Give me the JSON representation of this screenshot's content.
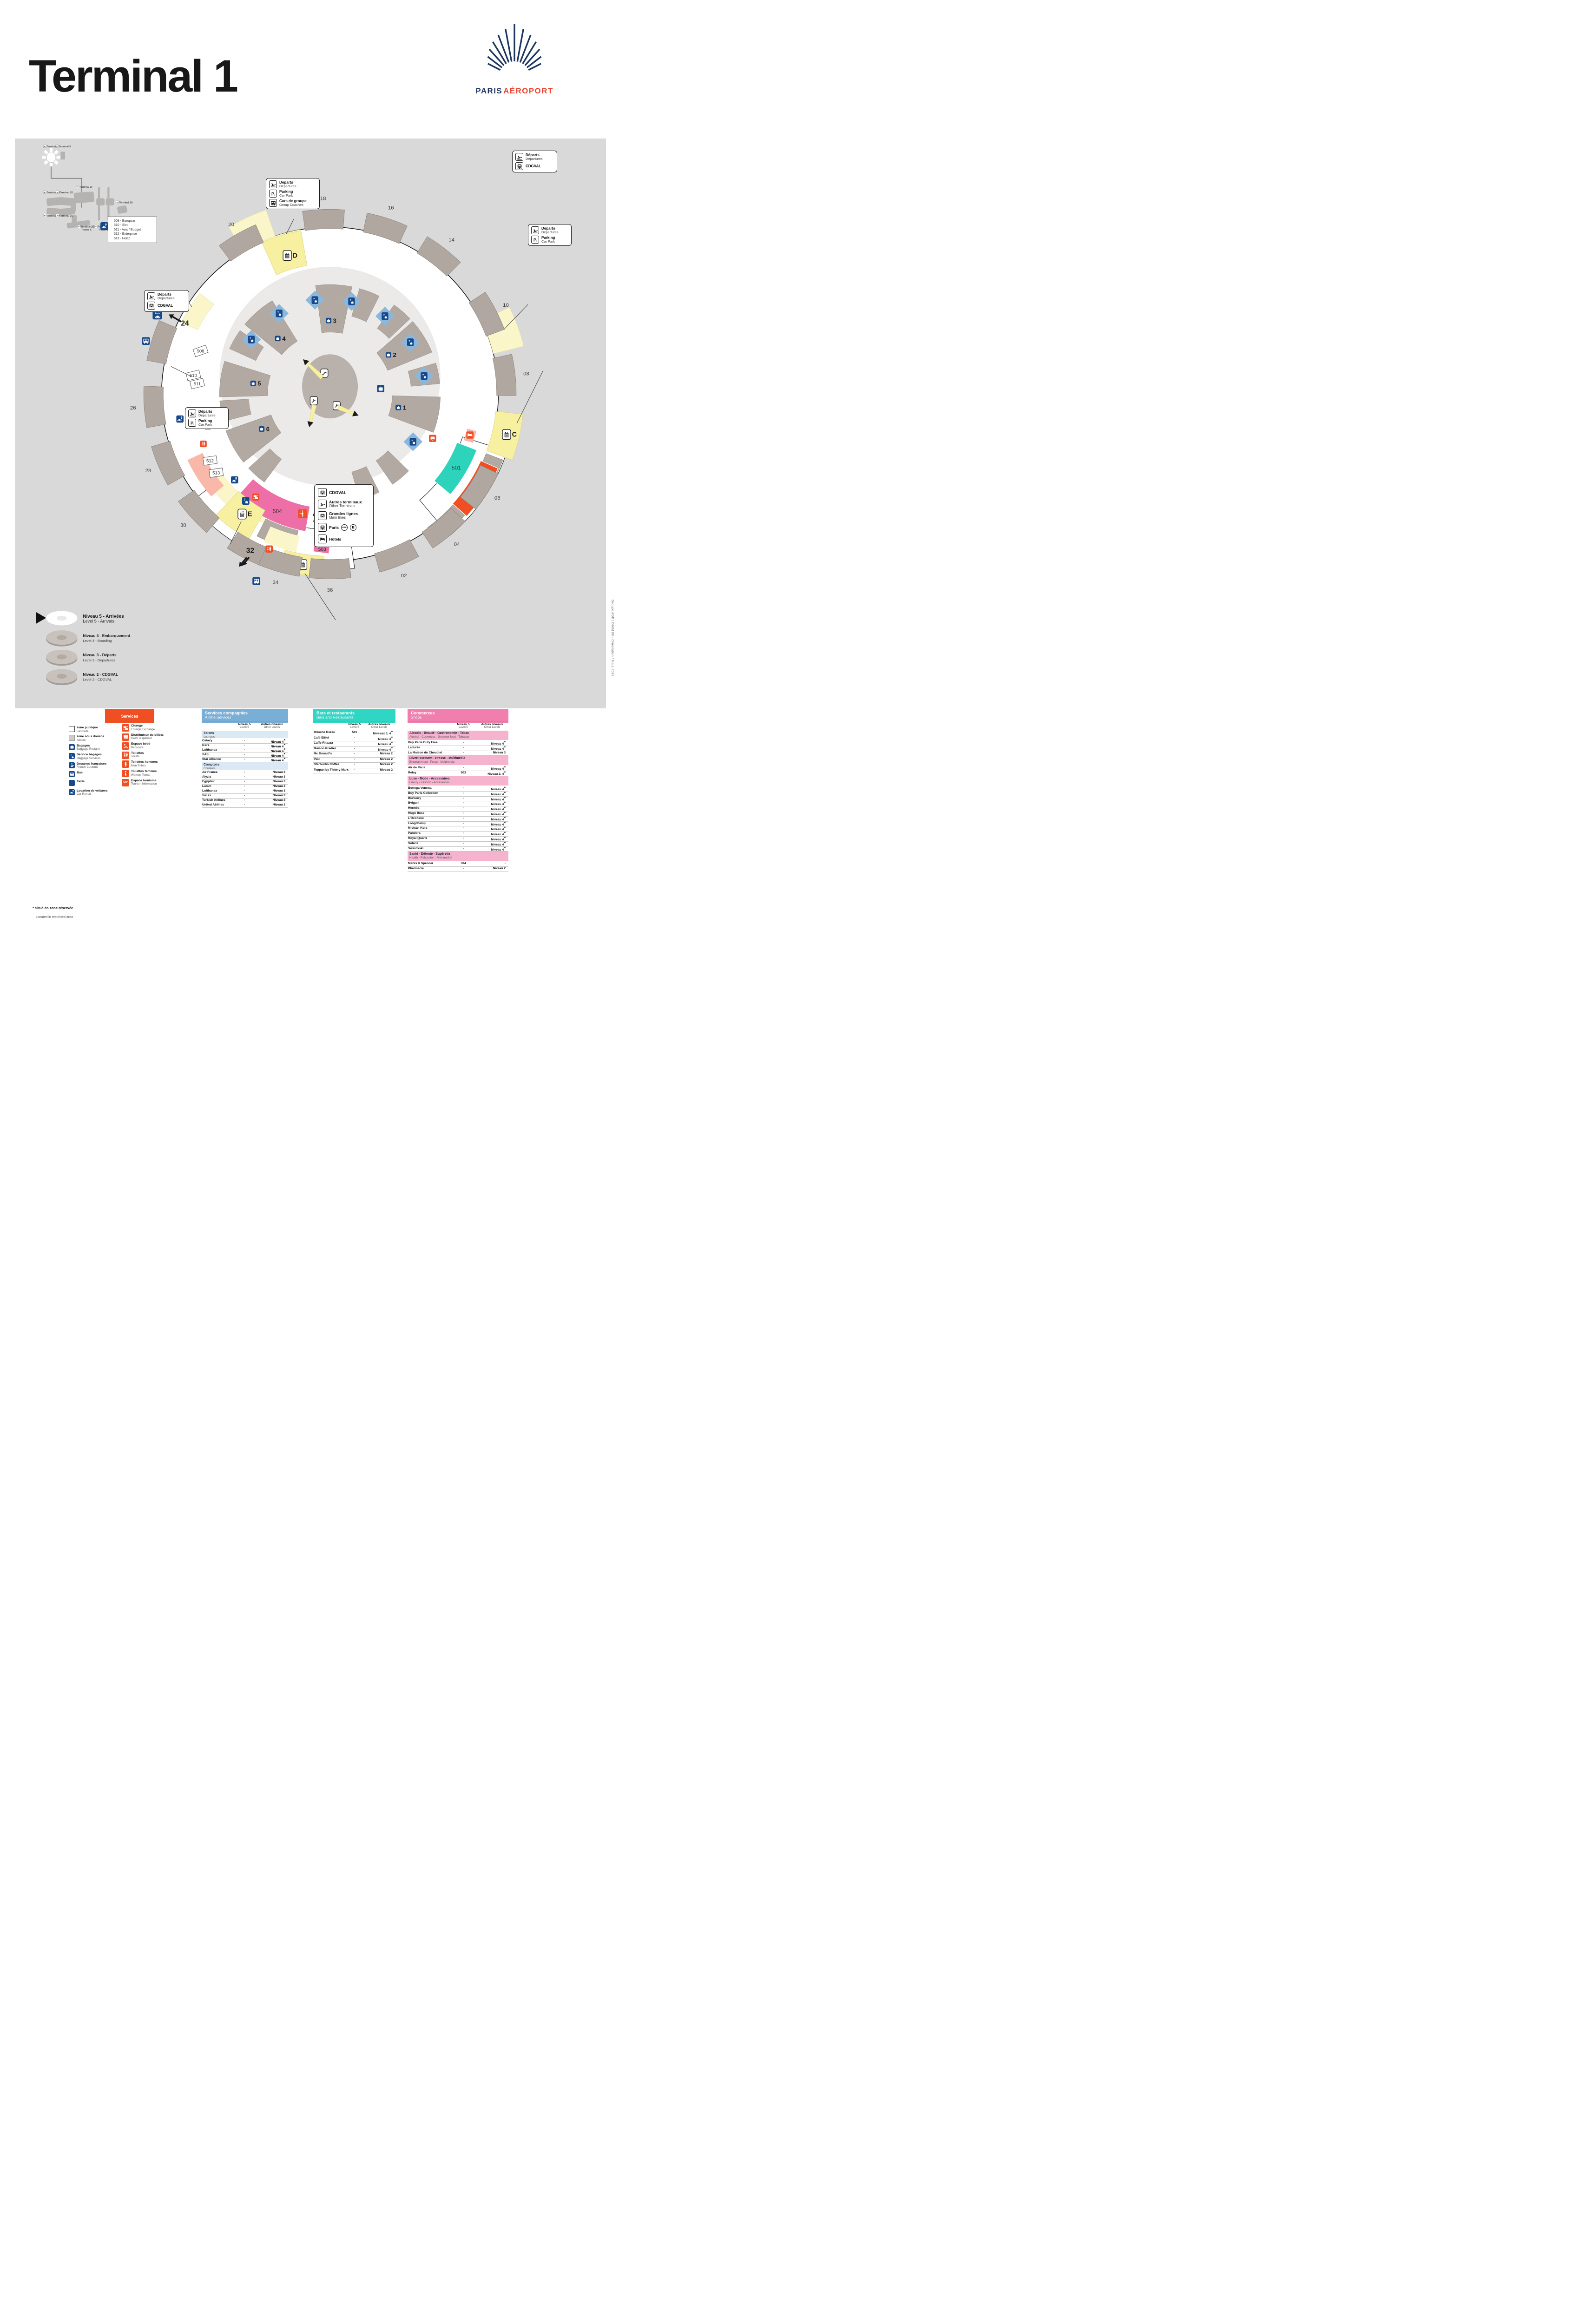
{
  "header": {
    "title": "Terminal 1",
    "logo": {
      "paris": "PARIS",
      "aeroport": "AÉROPORT"
    }
  },
  "minimap": {
    "terminals": [
      {
        "l1": "Terminal 1"
      },
      {
        "l1": "Terminal 3"
      },
      {
        "l1": "Terminal 2B"
      },
      {
        "l1": "Terminal 2D"
      },
      {
        "l1": "Terminal 2F"
      },
      {
        "l1": "Terminal 2A"
      },
      {
        "l1": "Terminal 2C"
      },
      {
        "l1": "Terminal 2E",
        "l2": "Portes K"
      },
      {
        "l1": "Terminal 2E",
        "l2": "Portes L"
      },
      {
        "l1": "Terminal 2E",
        "l2": "Portes M"
      },
      {
        "l1": "Terminal 2G"
      }
    ]
  },
  "map": {
    "gates": [
      "02",
      "04",
      "06",
      "08",
      "10",
      "14",
      "16",
      "18",
      "20",
      "26",
      "28",
      "30",
      "34",
      "36"
    ],
    "big_gates": [
      "24",
      "32"
    ],
    "stations": [
      "D",
      "E",
      "C",
      ""
    ],
    "halls": [
      "1",
      "2",
      "3",
      "4",
      "5",
      "6"
    ],
    "shops_on_map": [
      "501",
      "502",
      "503",
      "504"
    ],
    "counters": [
      "508",
      "510",
      "511",
      "512",
      "513"
    ],
    "taxi_label": "Taxis",
    "arrivals": {
      "fr": "Arrivées",
      "en": "Arrival"
    },
    "car_rental_list": [
      "508 - Europcar",
      "510 - Sixt",
      "511 - Avis / Budget",
      "512 - Enterprise",
      "513 - Hertz"
    ],
    "callouts": {
      "top": {
        "rows": [
          {
            "fr": "Départs",
            "en": "Departures",
            "icon": "takeoff"
          },
          {
            "fr": "Parking",
            "en": "Car Park",
            "icon": "p1"
          },
          {
            "fr": "Cars de groupe",
            "en": "Group Coaches",
            "icon": "bus"
          }
        ]
      },
      "left": {
        "rows": [
          {
            "fr": "Départs",
            "en": "Departures",
            "icon": "takeoff"
          },
          {
            "fr": "CDGVAL",
            "en": "",
            "icon": "train"
          }
        ]
      },
      "right_top": {
        "rows": [
          {
            "fr": "Départs",
            "en": "Departures",
            "icon": "takeoff"
          },
          {
            "fr": "CDGVAL",
            "en": "",
            "icon": "train"
          }
        ]
      },
      "right_mid": {
        "rows": [
          {
            "fr": "Départs",
            "en": "Departures",
            "icon": "takeoff"
          },
          {
            "fr": "Parking",
            "en": "Car Park",
            "icon": "p1"
          }
        ]
      },
      "bottom_left": {
        "rows": [
          {
            "fr": "Départs",
            "en": "Departures",
            "icon": "takeoff"
          },
          {
            "fr": "Parking",
            "en": "Car Park",
            "icon": "p1"
          }
        ]
      }
    },
    "transport_callout": [
      {
        "fr": "CDGVAL",
        "en": "",
        "icon": "train"
      },
      {
        "fr": "Autres terminaux",
        "en": "Other Terminals",
        "icon": "plane"
      },
      {
        "fr": "Grandes lignes",
        "en": "Main lines",
        "icon": "train"
      },
      {
        "fr": "Paris",
        "en": "",
        "icon": "train",
        "badges": [
          "RER",
          "B"
        ]
      },
      {
        "fr": "Hôtels",
        "en": "",
        "icon": "bed"
      }
    ],
    "levels": [
      {
        "fr": "Niveau 5 - Arrivées",
        "en": "Level 5 - Arrivals",
        "main": true
      },
      {
        "fr": "Niveau 4 - Embarquement",
        "en": "Level 4 - Boarding"
      },
      {
        "fr": "Niveau 3 - Départs",
        "en": "Level 3 - Departures"
      },
      {
        "fr": "Niveau 2 - CDGVAL",
        "en": "Level 2 - CDGVAL"
      }
    ],
    "credit": "Groupe ADP / DIAM 88 - Orientation / Mars 2018"
  },
  "legend": {
    "services": {
      "title": "Services",
      "general": [
        {
          "fr": "zone publique",
          "en": "Landside",
          "icon": "swatch-white"
        },
        {
          "fr": "zone sous douane",
          "en": "Airside",
          "icon": "swatch-gray"
        },
        {
          "fr": "Bagages",
          "en": "Baggage Reclaim",
          "icon": "bag"
        },
        {
          "fr": "Service bagages",
          "en": "Baggage Services",
          "icon": "qbag"
        },
        {
          "fr": "Douanes françaises",
          "en": "French Customs",
          "icon": "customs"
        },
        {
          "fr": "Bus",
          "en": "",
          "icon": "bus"
        },
        {
          "fr": "Taxis",
          "en": "",
          "icon": "taxi"
        },
        {
          "fr": "Location de voitures",
          "en": "Car Rental",
          "icon": "carkey"
        }
      ],
      "facilities": [
        {
          "fr": "Change",
          "en": "Foreign Exchange",
          "icon": "change"
        },
        {
          "fr": "Distributeur de billets",
          "en": "Cash Dispenser",
          "icon": "cash"
        },
        {
          "fr": "Espace bébé",
          "en": "Babycare",
          "icon": "baby"
        },
        {
          "fr": "Toilettes",
          "en": "Toilets",
          "icon": "wc"
        },
        {
          "fr": "Toilettes hommes",
          "en": "Men Toilets",
          "icon": "man"
        },
        {
          "fr": "Toilettes femmes",
          "en": "Women Toilets",
          "icon": "woman"
        },
        {
          "fr": "Espace tourisme",
          "en": "Tourism Information",
          "icon": "badge",
          "badge": "502"
        }
      ]
    },
    "col_headers": {
      "n5_fr": "Niveau 5",
      "n5_en": "Level 5",
      "ot_fr": "Autres niveaux",
      "ot_en": "Other Levels"
    },
    "airlines": {
      "title_fr": "Services compagnies",
      "title_en": "Airline Services",
      "sections": [
        {
          "band_fr": "Salons",
          "band_en": "Lounges",
          "rows": [
            {
              "name": "Galaxy",
              "l5": "-",
              "other": "Niveau 4",
              "star": true
            },
            {
              "name": "Icare",
              "l5": "-",
              "other": "Niveau 4",
              "star": true
            },
            {
              "name": "Lufthansa",
              "l5": "-",
              "other": "Niveau 4",
              "star": true
            },
            {
              "name": "SAS",
              "l5": "-",
              "other": "Niveau 4",
              "star": true
            },
            {
              "name": "Star Alliance",
              "l5": "-",
              "other": "Niveau 4",
              "star": true
            }
          ]
        },
        {
          "band_fr": "Comptoirs",
          "band_en": "Counters",
          "rows": [
            {
              "name": "Air France",
              "l5": "-",
              "other": "Niveau 3"
            },
            {
              "name": "Alyzia",
              "l5": "-",
              "other": "Niveau 3"
            },
            {
              "name": "Egyptair",
              "l5": "-",
              "other": "Niveau 3"
            },
            {
              "name": "Latam",
              "l5": "-",
              "other": "Niveau 3"
            },
            {
              "name": "Lufthansa",
              "l5": "-",
              "other": "Niveau 3"
            },
            {
              "name": "Swiss",
              "l5": "-",
              "other": "Niveau 3"
            },
            {
              "name": "Turkish Airlines",
              "l5": "-",
              "other": "Niveau 3"
            },
            {
              "name": "United Airlines",
              "l5": "-",
              "other": "Niveau 3"
            }
          ]
        }
      ]
    },
    "bars": {
      "title_fr": "Bars et restaurants",
      "title_en": "Bars and Restaurants",
      "sections": [
        {
          "rows": [
            {
              "name": "Brioche Dorée",
              "l5": "501",
              "other": "Niveaux 3, 4",
              "star": true
            },
            {
              "name": "Café Eiffel",
              "l5": "-",
              "other": "Niveau 4",
              "star": true
            },
            {
              "name": "Caffe Ritazza",
              "l5": "-",
              "other": "Niveau 4",
              "star": true
            },
            {
              "name": "Maison Pradier",
              "l5": "-",
              "other": "Niveau 4",
              "star": true
            },
            {
              "name": "Mc Donald's",
              "l5": "-",
              "other": "Niveau 2"
            },
            {
              "name": "Paul",
              "l5": "-",
              "other": "Niveau 2"
            },
            {
              "name": "Starbucks Coffee",
              "l5": "-",
              "other": "Niveau 2"
            },
            {
              "name": "Teppan by Thierry Marx",
              "l5": "-",
              "other": "Niveau 2"
            }
          ]
        }
      ]
    },
    "shops": {
      "title_fr": "Commerces",
      "title_en": "Shops",
      "sections": [
        {
          "band_fr": "Alcools - Beauté - Gastronomie - Tabac",
          "band_en": "Alcohol - Cosmetics - Gourmet food - Tobacco",
          "rows": [
            {
              "name": "Buy Paris Duty Free",
              "l5": "-",
              "other": "Niveau 4",
              "star": true
            },
            {
              "name": "Ladurée",
              "l5": "-",
              "other": "Niveau 4",
              "star": true
            },
            {
              "name": "La Maison du Chocolat",
              "l5": "-",
              "other": "Niveau 3"
            }
          ]
        },
        {
          "band_fr": "Divertissement - Presse - Multimédia",
          "band_en": "Entertainment - Press - Multimedia",
          "rows": [
            {
              "name": "Air de Paris",
              "l5": "-",
              "other": "Niveau 4",
              "star": true
            },
            {
              "name": "Relay",
              "l5": "503",
              "other": "Niveau 2, 4",
              "star": true
            }
          ]
        },
        {
          "band_fr": "Luxe - Mode - Accessoires",
          "band_en": "Luxury - Fashion - Accessories",
          "rows": [
            {
              "name": "Bottega Venetta",
              "l5": "-",
              "other": "Niveau 4",
              "star": true
            },
            {
              "name": "Buy Paris Collection",
              "l5": "-",
              "other": "Niveau 4",
              "star": true
            },
            {
              "name": "Burberry",
              "l5": "-",
              "other": "Niveau 4",
              "star": true
            },
            {
              "name": "Bvlgari",
              "l5": "-",
              "other": "Niveau 4",
              "star": true
            },
            {
              "name": "Hermès",
              "l5": "-",
              "other": "Niveau 4",
              "star": true
            },
            {
              "name": "Hugo Boss",
              "l5": "-",
              "other": "Niveau 4",
              "star": true
            },
            {
              "name": "L'Occitane",
              "l5": "-",
              "other": "Niveau 4",
              "star": true
            },
            {
              "name": "Longchamp",
              "l5": "-",
              "other": "Niveau 4",
              "star": true
            },
            {
              "name": "Michael Kors",
              "l5": "-",
              "other": "Niveau 4",
              "star": true
            },
            {
              "name": "Pandora",
              "l5": "-",
              "other": "Niveau 4",
              "star": true
            },
            {
              "name": "Royal Quartz",
              "l5": "-",
              "other": "Niveau 4",
              "star": true
            },
            {
              "name": "Solaris",
              "l5": "-",
              "other": "Niveau 4",
              "star": true
            },
            {
              "name": "Swarovski",
              "l5": "-",
              "other": "Niveau 4",
              "star": true
            }
          ]
        },
        {
          "band_fr": "Santé - Détente - Supérette",
          "band_en": "Health - Relaxation - Mini-market",
          "rows": [
            {
              "name": "Marks & Spencer",
              "l5": "504",
              "other": "-"
            },
            {
              "name": "Pharmacie",
              "l5": "-",
              "other": "Niveau 2"
            }
          ]
        }
      ]
    }
  },
  "footnote": {
    "star": "*",
    "fr": "Situé en zone réservée",
    "en": "Located in restricted area"
  },
  "colors": {
    "navy": "#17498a",
    "orange": "#f04e23",
    "teal": "#2ed3bb",
    "pink": "#ee6fa8",
    "header_blue": "#79aed6",
    "header_teal": "#2fd6c3",
    "header_pink": "#f07fae",
    "map_bg": "#d9d9d9",
    "yellow": "#f6f0a0"
  }
}
